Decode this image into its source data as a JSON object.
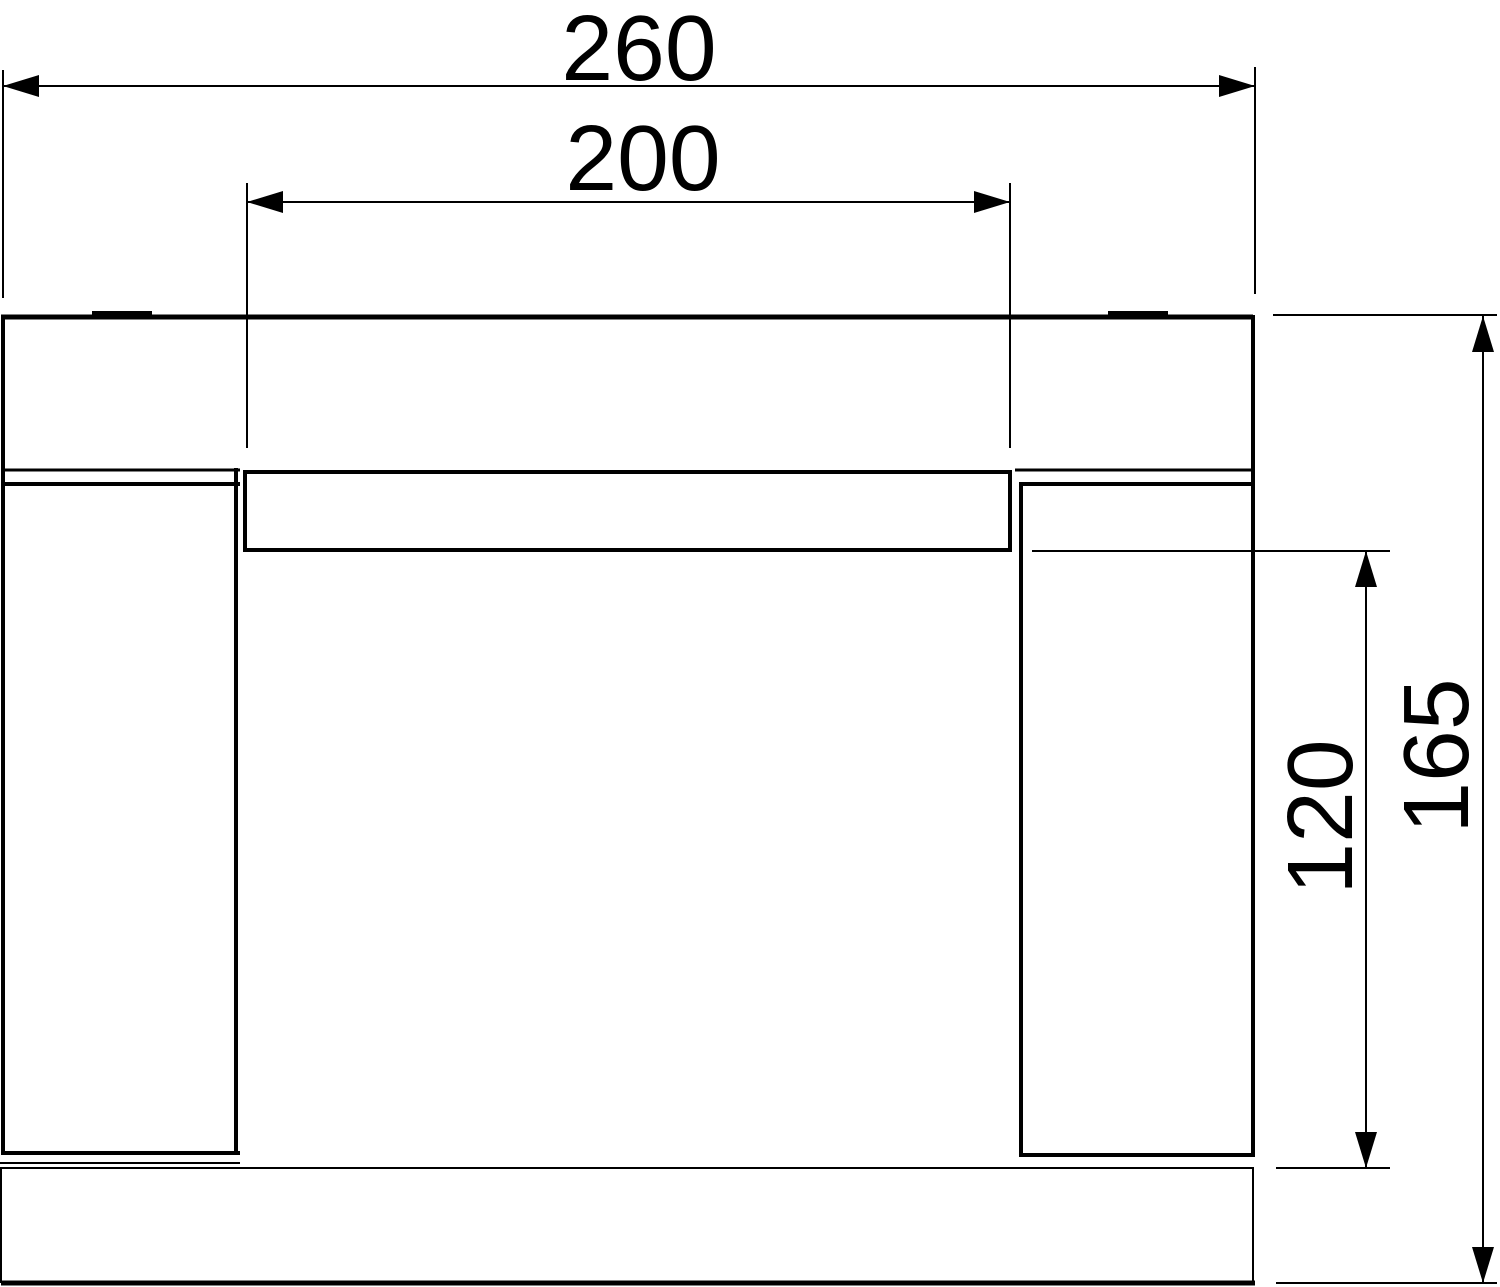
{
  "drawing": {
    "background_color": "#ffffff",
    "line_color": "#000000"
  },
  "dimensions": [
    {
      "id": "overall-width",
      "label": "260",
      "orientation": "horizontal"
    },
    {
      "id": "opening-width",
      "label": "200",
      "orientation": "horizontal"
    },
    {
      "id": "inner-height",
      "label": "120",
      "orientation": "vertical"
    },
    {
      "id": "overall-height",
      "label": "165",
      "orientation": "vertical"
    }
  ]
}
